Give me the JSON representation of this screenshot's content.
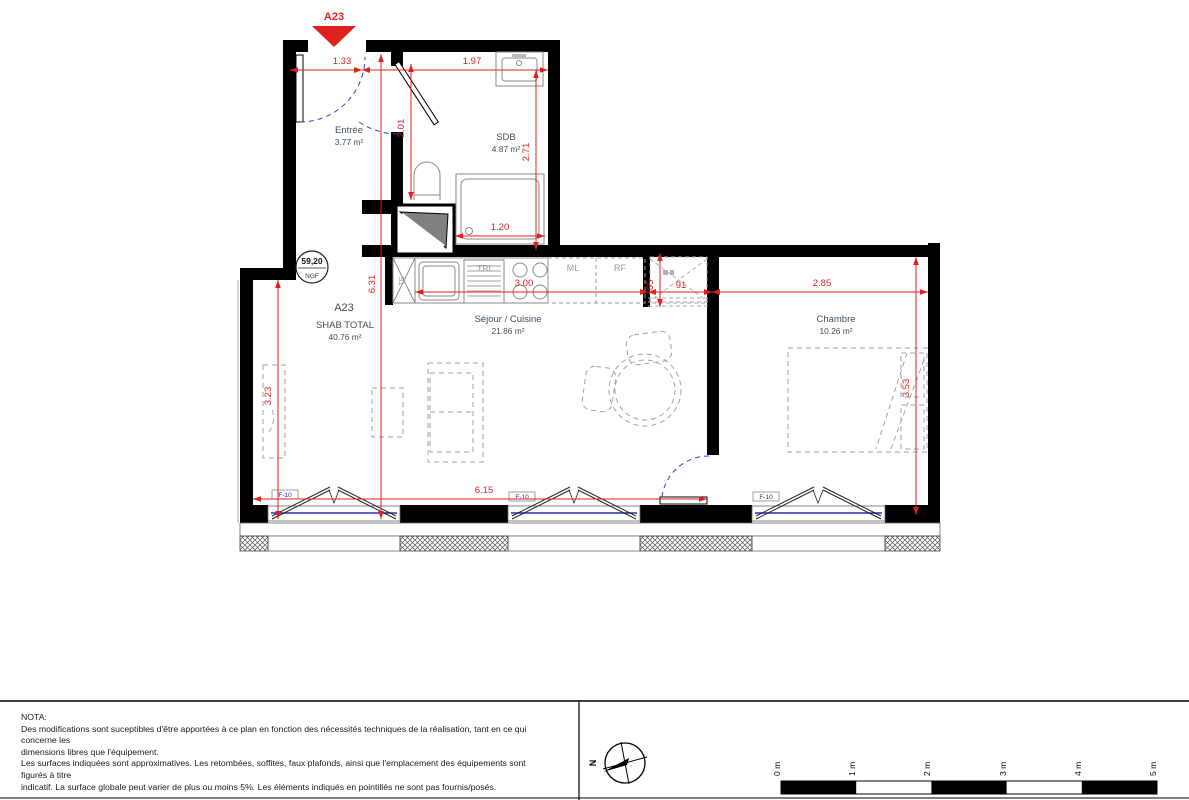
{
  "unit_marker": {
    "label": "A23"
  },
  "level_marker": {
    "value": "59,20",
    "datum": "NGF"
  },
  "rooms": [
    {
      "name": "Entrée",
      "area": "3.77 m²"
    },
    {
      "name": "SDB",
      "area": "4.87 m²"
    },
    {
      "name": "Séjour / Cuisine",
      "area": "21.86 m²"
    },
    {
      "name": "Chambre",
      "area": "10.26 m²"
    }
  ],
  "summary": {
    "unit": "A23",
    "title": "SHAB TOTAL",
    "area": "40.76 m²"
  },
  "dimensions": {
    "entree_width": "1.33",
    "sdb_width": "1.97",
    "entree_depth": "2.01",
    "sdb_depth": "2.71",
    "sdb_inner_width": "1.20",
    "sejour_depth": "6.31",
    "sejour_left_depth": "3.23",
    "cuisine_width": "3.00",
    "placard_depth": "65",
    "placard_width": "91",
    "chambre_width": "2.85",
    "chambre_depth": "3.53",
    "sejour_width": "6.15"
  },
  "kitchen_labels": {
    "te": "TE",
    "tri": "TRI",
    "ml": "ML",
    "rf": "RF"
  },
  "window_label": "F-10",
  "compass": {
    "north": "N"
  },
  "scale_bar": {
    "ticks": [
      "0 m",
      "1 m",
      "2 m",
      "3 m",
      "4 m",
      "5 m"
    ]
  },
  "nota": {
    "lines": [
      "NOTA:",
      "Des modifications sont suceptibles d'être apportées à ce plan en fonction des nécessités techniques de la réalisation, tant en ce qui",
      "concerne les",
      "dimensions libres que l'équipement.",
      "Les surfaces indiquées sont approximatives. Les retombées, soffites, faux plafonds, ainsi que l'emplacement des équipements sont",
      "figurés à titre",
      "indicatif. La surface globale peut varier de plus ou moins 5%. Les éléments indiqués en pointillés ne sont pas fournis/posés."
    ]
  }
}
